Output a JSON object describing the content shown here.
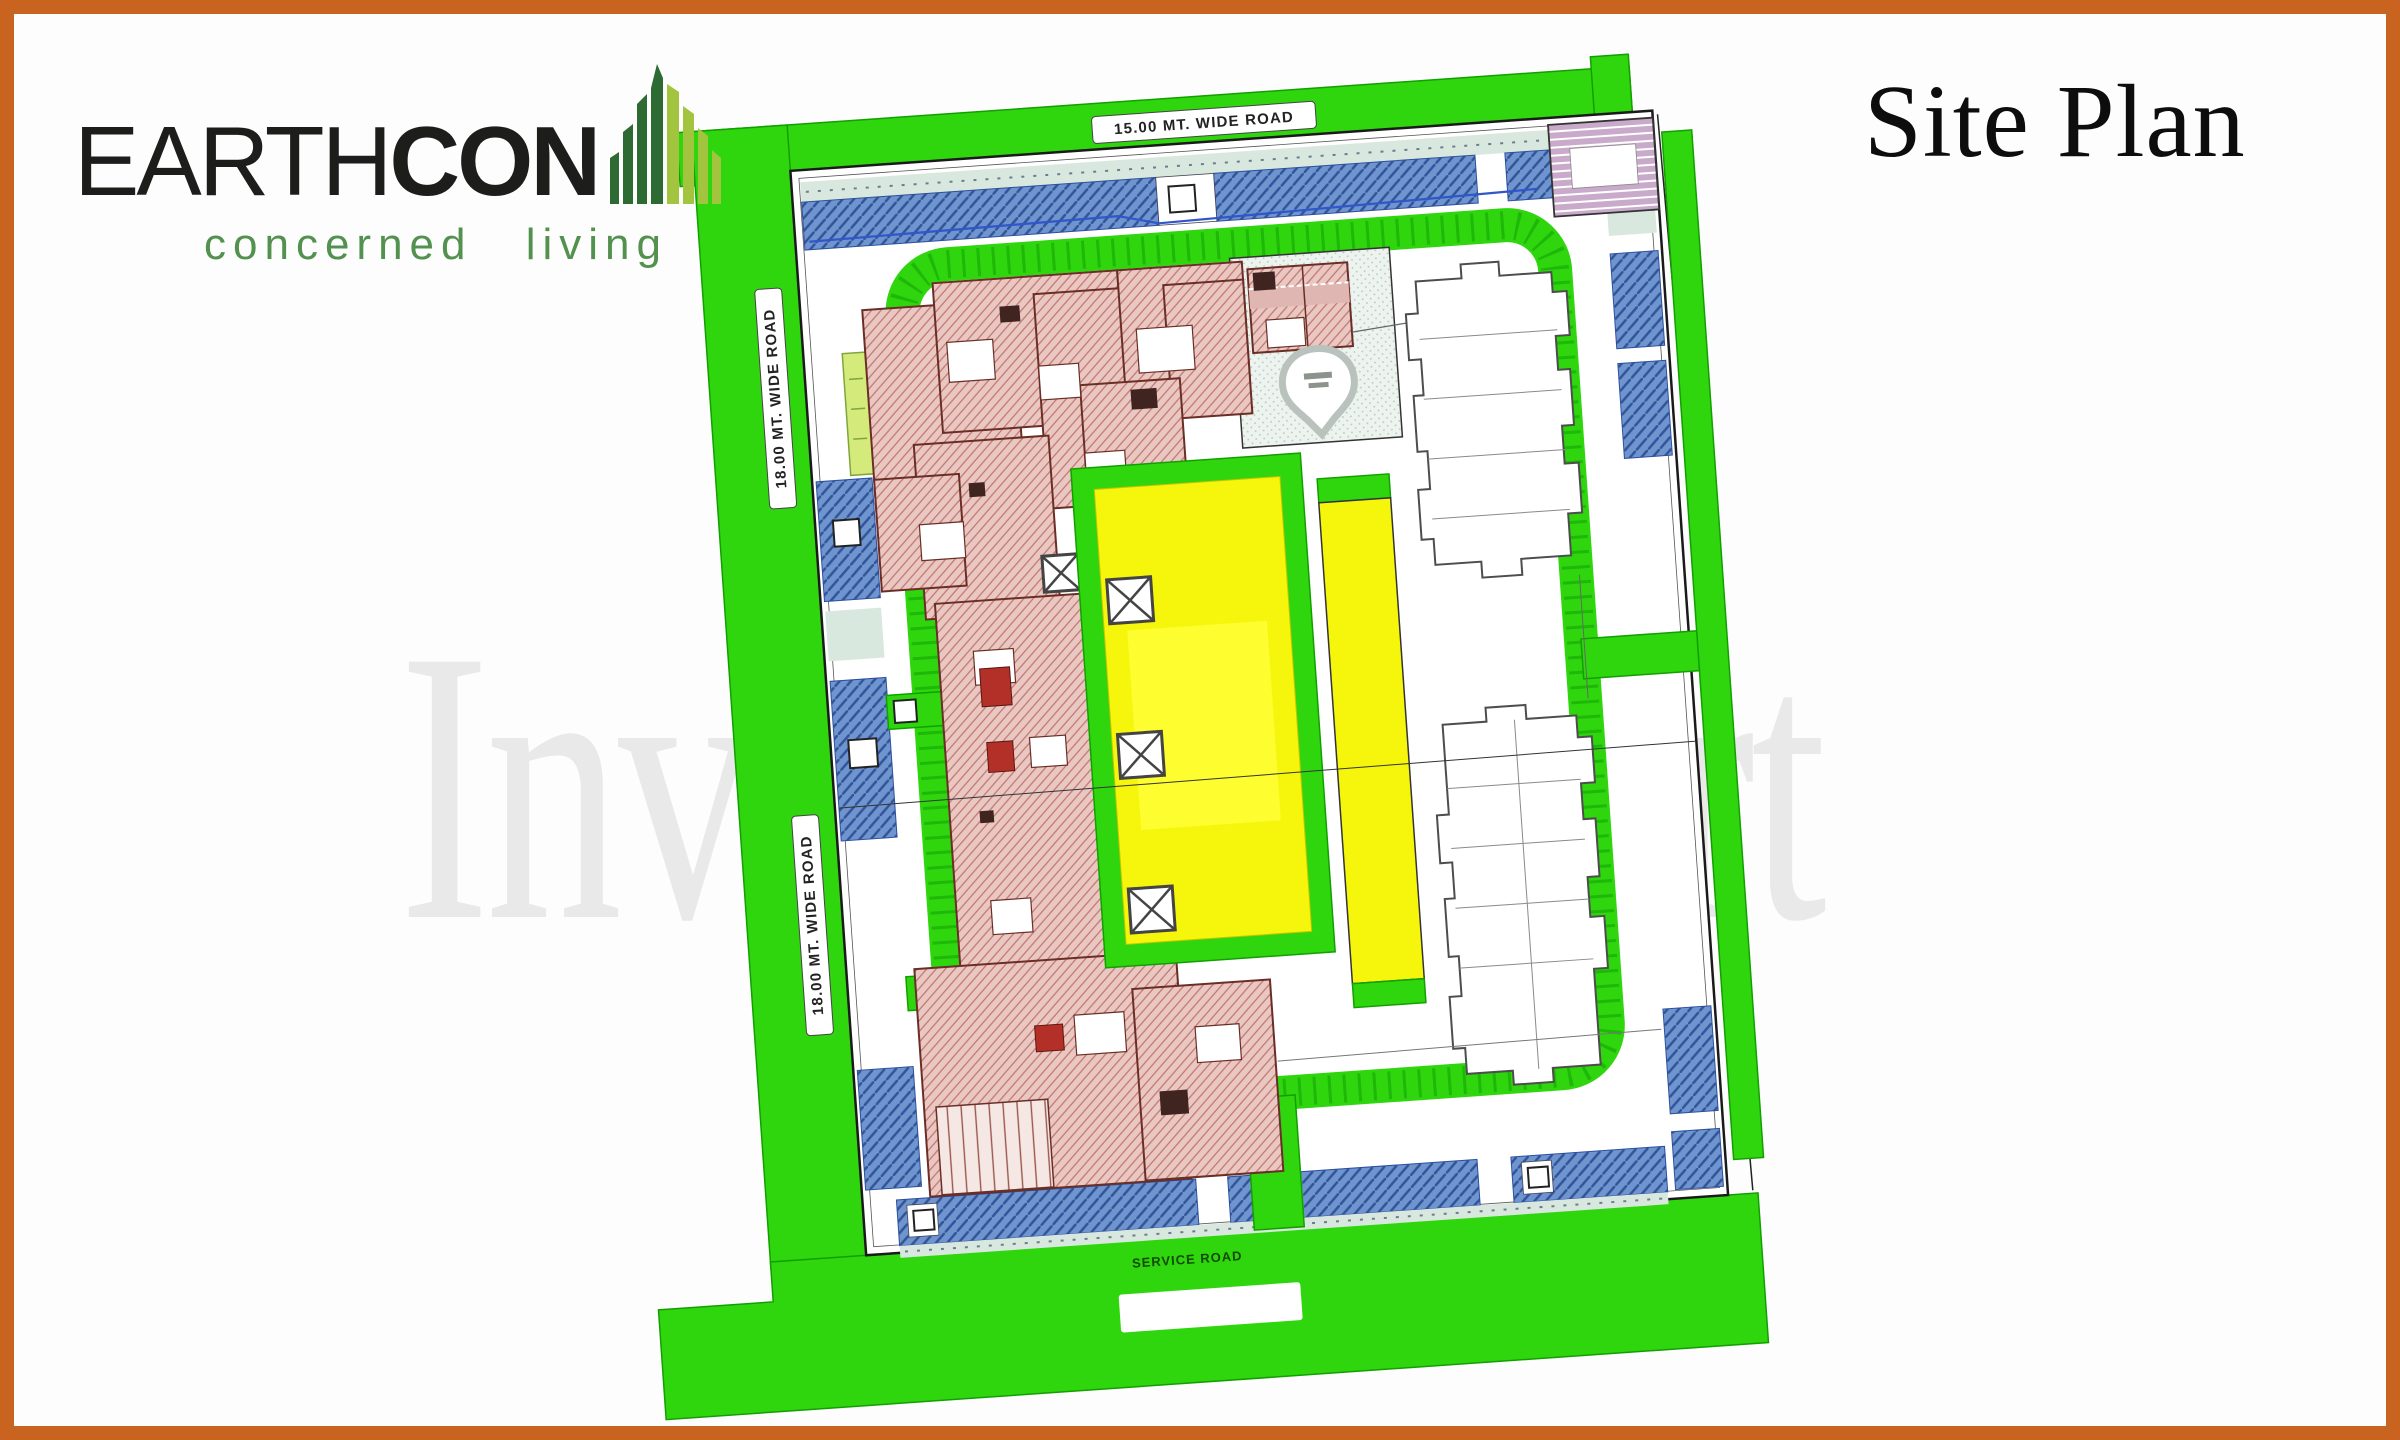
{
  "header": {
    "brand": {
      "name_primary": "EARTH",
      "name_secondary": "CON",
      "tagline": "concerned living"
    },
    "page_title": "Site Plan"
  },
  "watermark": {
    "text": "Invester Mart"
  },
  "plan": {
    "road_labels": {
      "top": "15.00 MT. WIDE ROAD",
      "left_upper": "18.00 MT. WIDE ROAD",
      "left_lower": "18.00 MT. WIDE ROAD",
      "bottom": "SERVICE ROAD"
    },
    "colors": {
      "frame_orange": "#c8641f",
      "road_green": "#2fd60e",
      "lawn_yellow": "#f6f60c",
      "parking_blue": "#6f95cf",
      "building_pink": "#e9c8c3",
      "block_purple": "#c9aacb",
      "logo_green_dark": "#2e6b33",
      "logo_green_light": "#a3c43e"
    }
  }
}
